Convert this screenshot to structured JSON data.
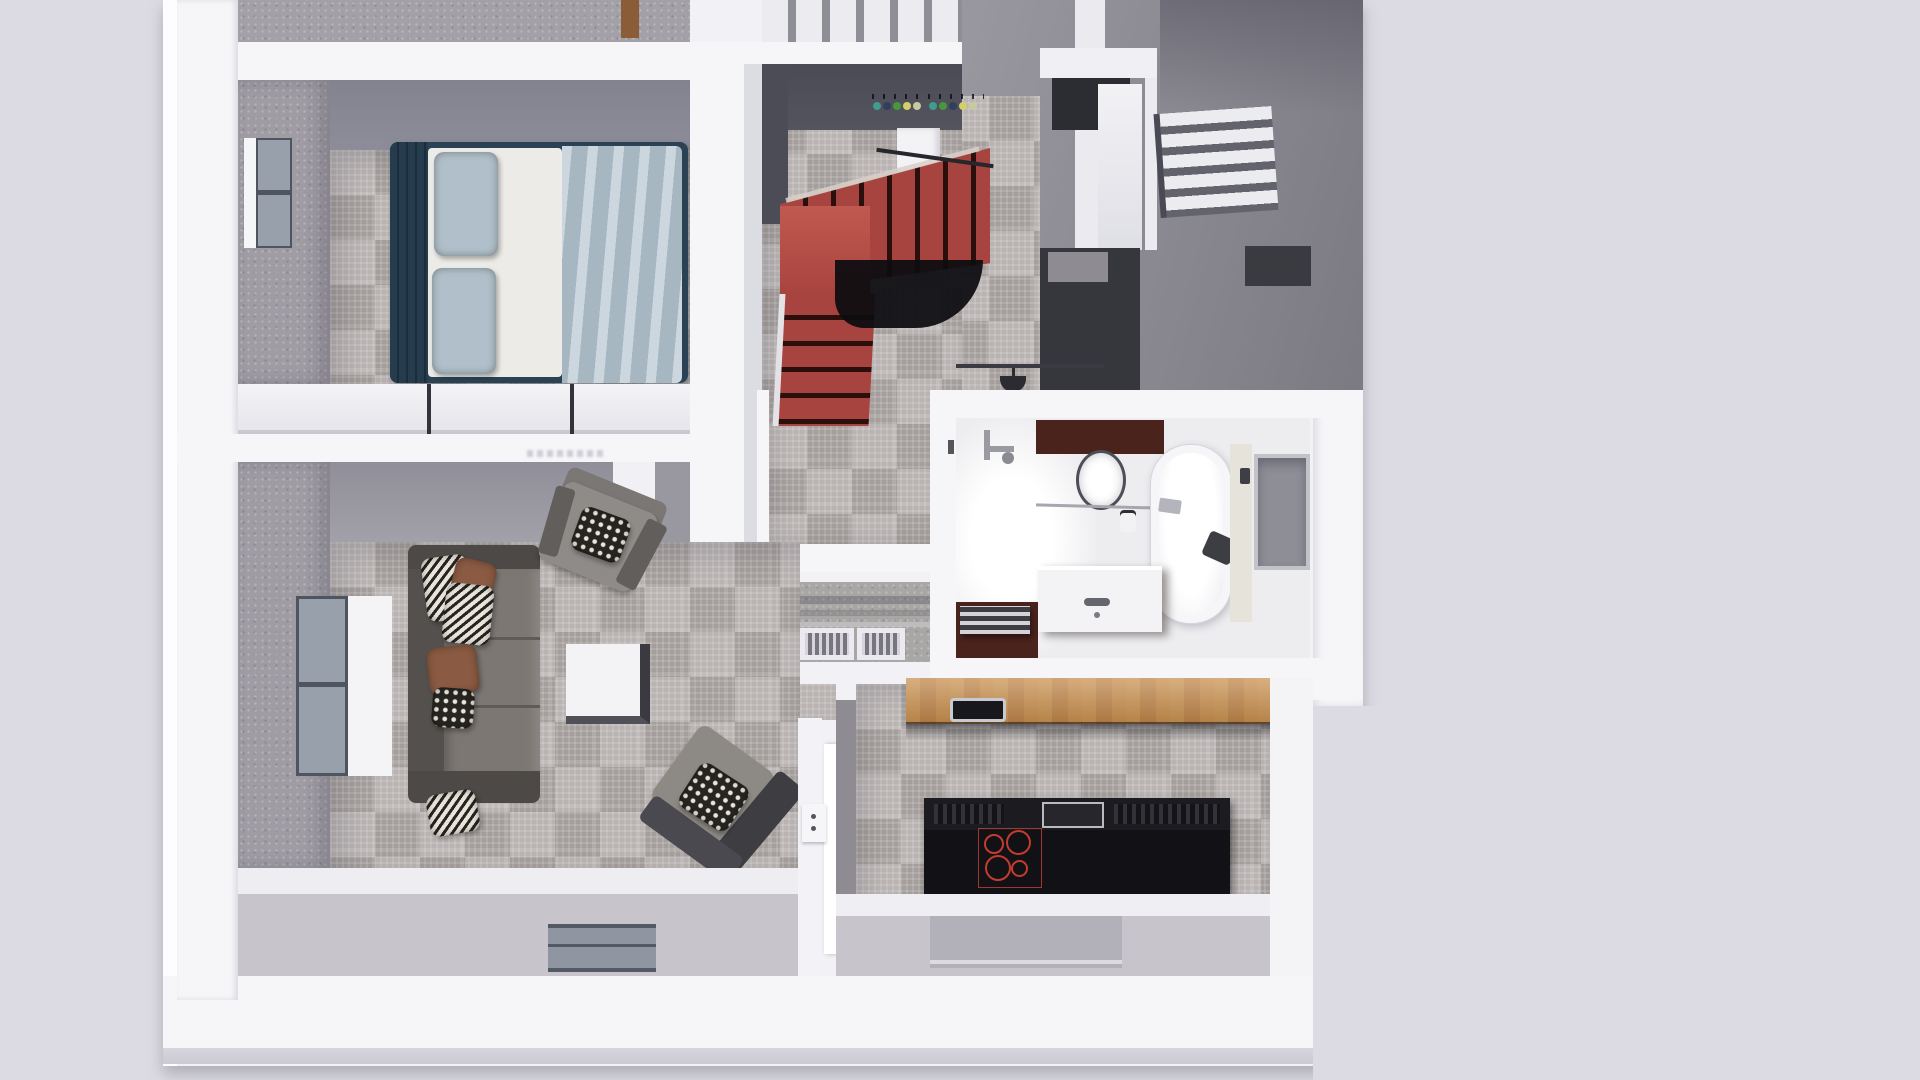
{
  "meta": {
    "title": "3D floor-plan render, top-down dollhouse view",
    "render_style": "architectural visualization, no UI chrome, no visible text"
  },
  "palette": {
    "bg": "#dcdbe3",
    "wallBase": "#f2f2f6",
    "wallWhite": "#f6f6f9",
    "wallBright": "#ffffff",
    "doorWhite": "#fdfdff",
    "shadowLine": "#d6d5de",
    "carpet": "#b2acaa",
    "carpetEntry": "#a9a6a6",
    "speckleWall": "#a09ca4",
    "faceBlue": "#8d8d99",
    "faceGray": "#8f8d95",
    "faceDark": "#54545e",
    "faceDarker": "#4c4c56",
    "bedFrame": "#2a4254",
    "bedFrameDark": "#243c4d",
    "mattress": "#ecebe7",
    "pillowBlue": "#b0bfc9",
    "blanket": "#b8c7d1",
    "stairRed": "#a8443f",
    "stairRedLight": "#c05a50",
    "stairDark": "#2a0f0c",
    "railBlack": "#0c0c10",
    "wood": "#c8914f",
    "woodDark": "#8a5c38",
    "steel": "#b9bac2",
    "islandBlack": "#121115",
    "islandTop": "#1c1b1f",
    "burnerRed": "#c23c30",
    "brown": "#4a231d",
    "tubWhite": "#f6f6f9",
    "nicheGray": "#8e8e97",
    "sofaBack": "#53504d",
    "sofaSeat": "#7c7773",
    "sofaArm": "#4c4946",
    "patternDark": "#26251f",
    "patternLight": "#e9e4dc",
    "pillowBrown": "#8a5a42",
    "chairGray": "#8f8b88",
    "chairDark": "#3e3d41",
    "tableWhite": "#f3f3f5",
    "tableEdgeR": "#3a3a40",
    "tableEdgeB": "#505057",
    "glass": "#98a0ac",
    "frameDark": "#4e5560",
    "exterior": "#c7c5cb",
    "exteriorRecess": "#b2b0b8",
    "grilleLight": "#d6d4da",
    "grilleDark": "#77757e",
    "hookTeal": "#3f9c8f",
    "hookNavy": "#30405c",
    "hookGreen": "#46973f",
    "hookYellow": "#d3d069",
    "hookCream": "#c9c9a0"
  },
  "rooms": [
    {
      "id": "bedroom",
      "label": "Bedroom",
      "furniture": [
        "double bed with teal frame",
        "blue pillows",
        "light-blue blanket",
        "white dresser row",
        "window"
      ]
    },
    {
      "id": "stairwell",
      "label": "Stairwell",
      "furniture": [
        "red L-shaped staircase",
        "black under-stair rail",
        "coat hooks with colored knobs",
        "white wardrobe"
      ]
    },
    {
      "id": "upper-hall",
      "label": "Upper hall",
      "furniture": [
        "dark desk",
        "stairs to upper floor",
        "bright doorway"
      ]
    },
    {
      "id": "bathroom",
      "label": "Bathroom",
      "furniture": [
        "freestanding bathtub",
        "oval sink",
        "white vanity",
        "towel rack",
        "wall niche",
        "pendant lamp",
        "brown accent walls"
      ]
    },
    {
      "id": "entry",
      "label": "Entry hall",
      "furniture": [
        "two floor grilles"
      ]
    },
    {
      "id": "living-room",
      "label": "Living room",
      "furniture": [
        "charcoal sofa with patterned pillows",
        "gray armchair",
        "gray lounge chair",
        "white cube coffee table",
        "window",
        "plan-view window in bottom wall"
      ]
    },
    {
      "id": "kitchen",
      "label": "Kitchen",
      "furniture": [
        "wooden counter with sink",
        "black cooktop island with 4 red burners",
        "open white door",
        "small wall panel"
      ]
    }
  ],
  "details": {
    "coat_hook_colors_left": [
      "hookTeal",
      "hookNavy",
      "hookGreen",
      "hookYellow",
      "hookCream"
    ],
    "coat_hook_colors_right": [
      "hookTeal",
      "hookGreen",
      "hookNavy",
      "hookYellow",
      "hookCream"
    ],
    "burner_count": 4,
    "lower_stair_steps": 5,
    "upper_stair_steps": 7,
    "dresser_segments": 3,
    "entry_grilles": 2,
    "sofa_pillows": {
      "zigzag": 3,
      "brown": 2,
      "dotted": 1
    }
  }
}
